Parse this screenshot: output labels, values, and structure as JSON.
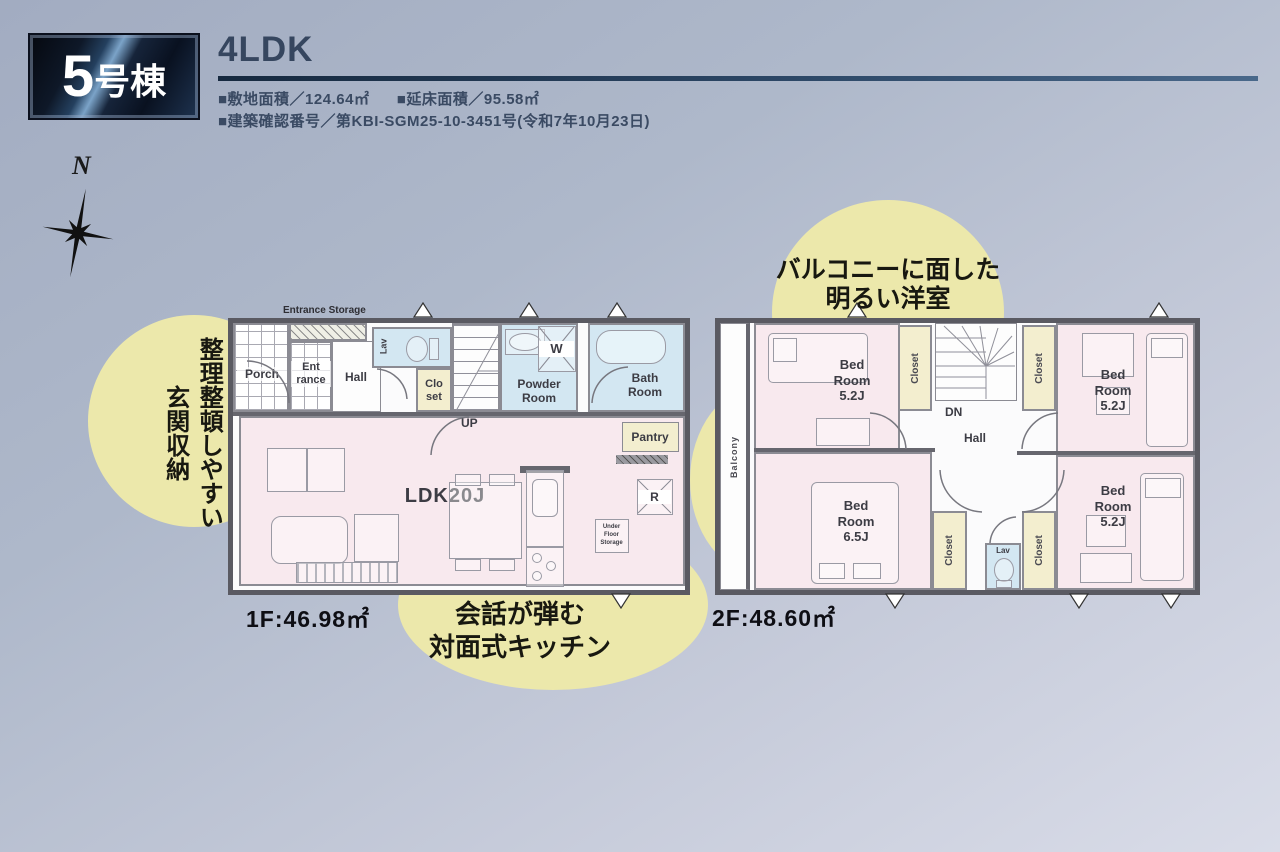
{
  "header": {
    "badge_number": "5",
    "badge_suffix": "号棟",
    "plan_type": "4LDK",
    "site_area": "■敷地面積／124.64㎡",
    "floor_area": "■延床面積／95.58㎡",
    "building_permit": "■建築確認番号／第KBI-SGM25-10-3451号(令和7年10月23日)"
  },
  "compass": {
    "north_label": "N"
  },
  "callouts": {
    "entrance_storage": "整理整頓しやすい\n玄関収納",
    "kitchen": "会話が弾む\n対面式キッチン",
    "balcony_rooms": "バルコニーに面した\n明るい洋室"
  },
  "colors": {
    "accent_yellow": "#ece8ab",
    "room_pink": "#f8e9ee",
    "wet_area_blue": "#d3e7f2",
    "closet_cream": "#f3eecf",
    "header_navy": "#1c2c45"
  },
  "floor1": {
    "area_label": "1F:46.98㎡",
    "labels": {
      "porch": "Porch",
      "entrance": "Ent\nrance",
      "entrance_storage": "Entrance Storage",
      "hall": "Hall",
      "lav": "Lav",
      "closet": "Clo\nset",
      "up": "UP",
      "powder_room": "Powder\nRoom",
      "washer": "W",
      "bath_room": "Bath\nRoom",
      "ldk": "LDK20J",
      "pantry": "Pantry",
      "refrigerator": "R",
      "under_floor_storage": "Under\nFloor\nStorage"
    }
  },
  "floor2": {
    "area_label": "2F:48.60㎡",
    "labels": {
      "balcony": "Balcony",
      "closet": "Closet",
      "dn": "DN",
      "hall": "Hall",
      "lav": "Lav",
      "bedroom_52": "Bed\nRoom\n5.2J",
      "bedroom_65": "Bed\nRoom\n6.5J"
    }
  }
}
